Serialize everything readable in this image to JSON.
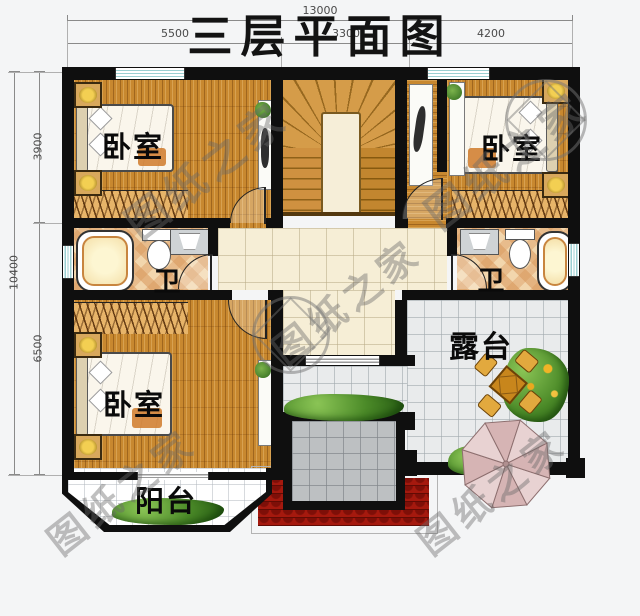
{
  "title": "三层平面图",
  "watermark_text": "图纸之家",
  "dimensions": {
    "top_total": "13000",
    "top_segments": [
      "5500",
      "3300",
      "4200"
    ],
    "left_total": "10400",
    "left_segments": [
      "3900",
      "6500"
    ]
  },
  "rooms": {
    "bedroom_top_left": "卧室",
    "bedroom_top_right": "卧室",
    "bedroom_bottom_left": "卧室",
    "bath_left": "卫",
    "bath_right": "卫",
    "terrace": "露台",
    "balcony": "阳台"
  }
}
